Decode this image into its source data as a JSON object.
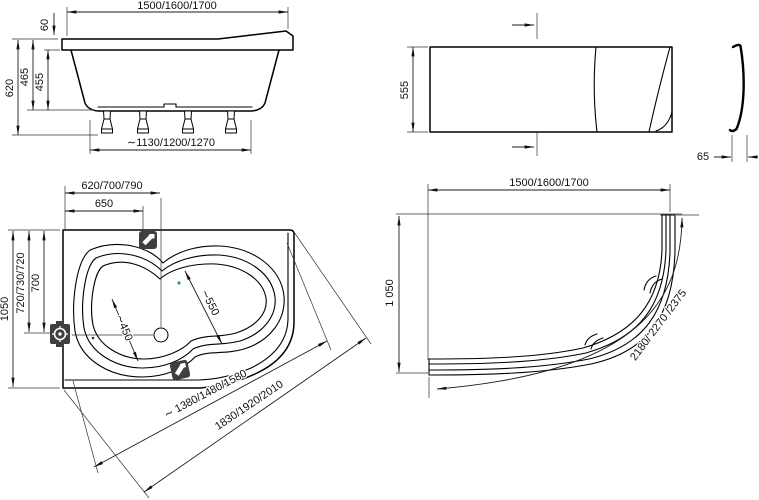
{
  "views": {
    "side": {
      "label_length": "1500/1600/1700",
      "label_rim_drop": "60",
      "label_total_height": "620",
      "label_height_outer": "465",
      "label_height_inner": "455",
      "label_support_span": "∼1130/1200/1270"
    },
    "front": {
      "label_panel_height": "555",
      "label_profile_depth": "65"
    },
    "plan": {
      "label_back_offset": "620/700/790",
      "label_faucet_offset": "650",
      "label_width": "1050",
      "label_drain_offset_variants": "720/730/720",
      "label_drain_offset": "700",
      "label_seat_width": "∼450",
      "label_basin_width": "∼550",
      "label_inner_edge_length": "∼ 1380/1480/1580",
      "label_outer_edge_length": "1830/1920/2010"
    },
    "apron": {
      "label_length": "1500/1600/1700",
      "label_height": "1 050",
      "label_arc_length": "2180/ 2270 /2375"
    },
    "icons": {
      "faucet_deck_top": "faucet-icon",
      "faucet_deck_bottom": "faucet-icon",
      "drain_fitting": "drain-fitting-icon"
    }
  }
}
